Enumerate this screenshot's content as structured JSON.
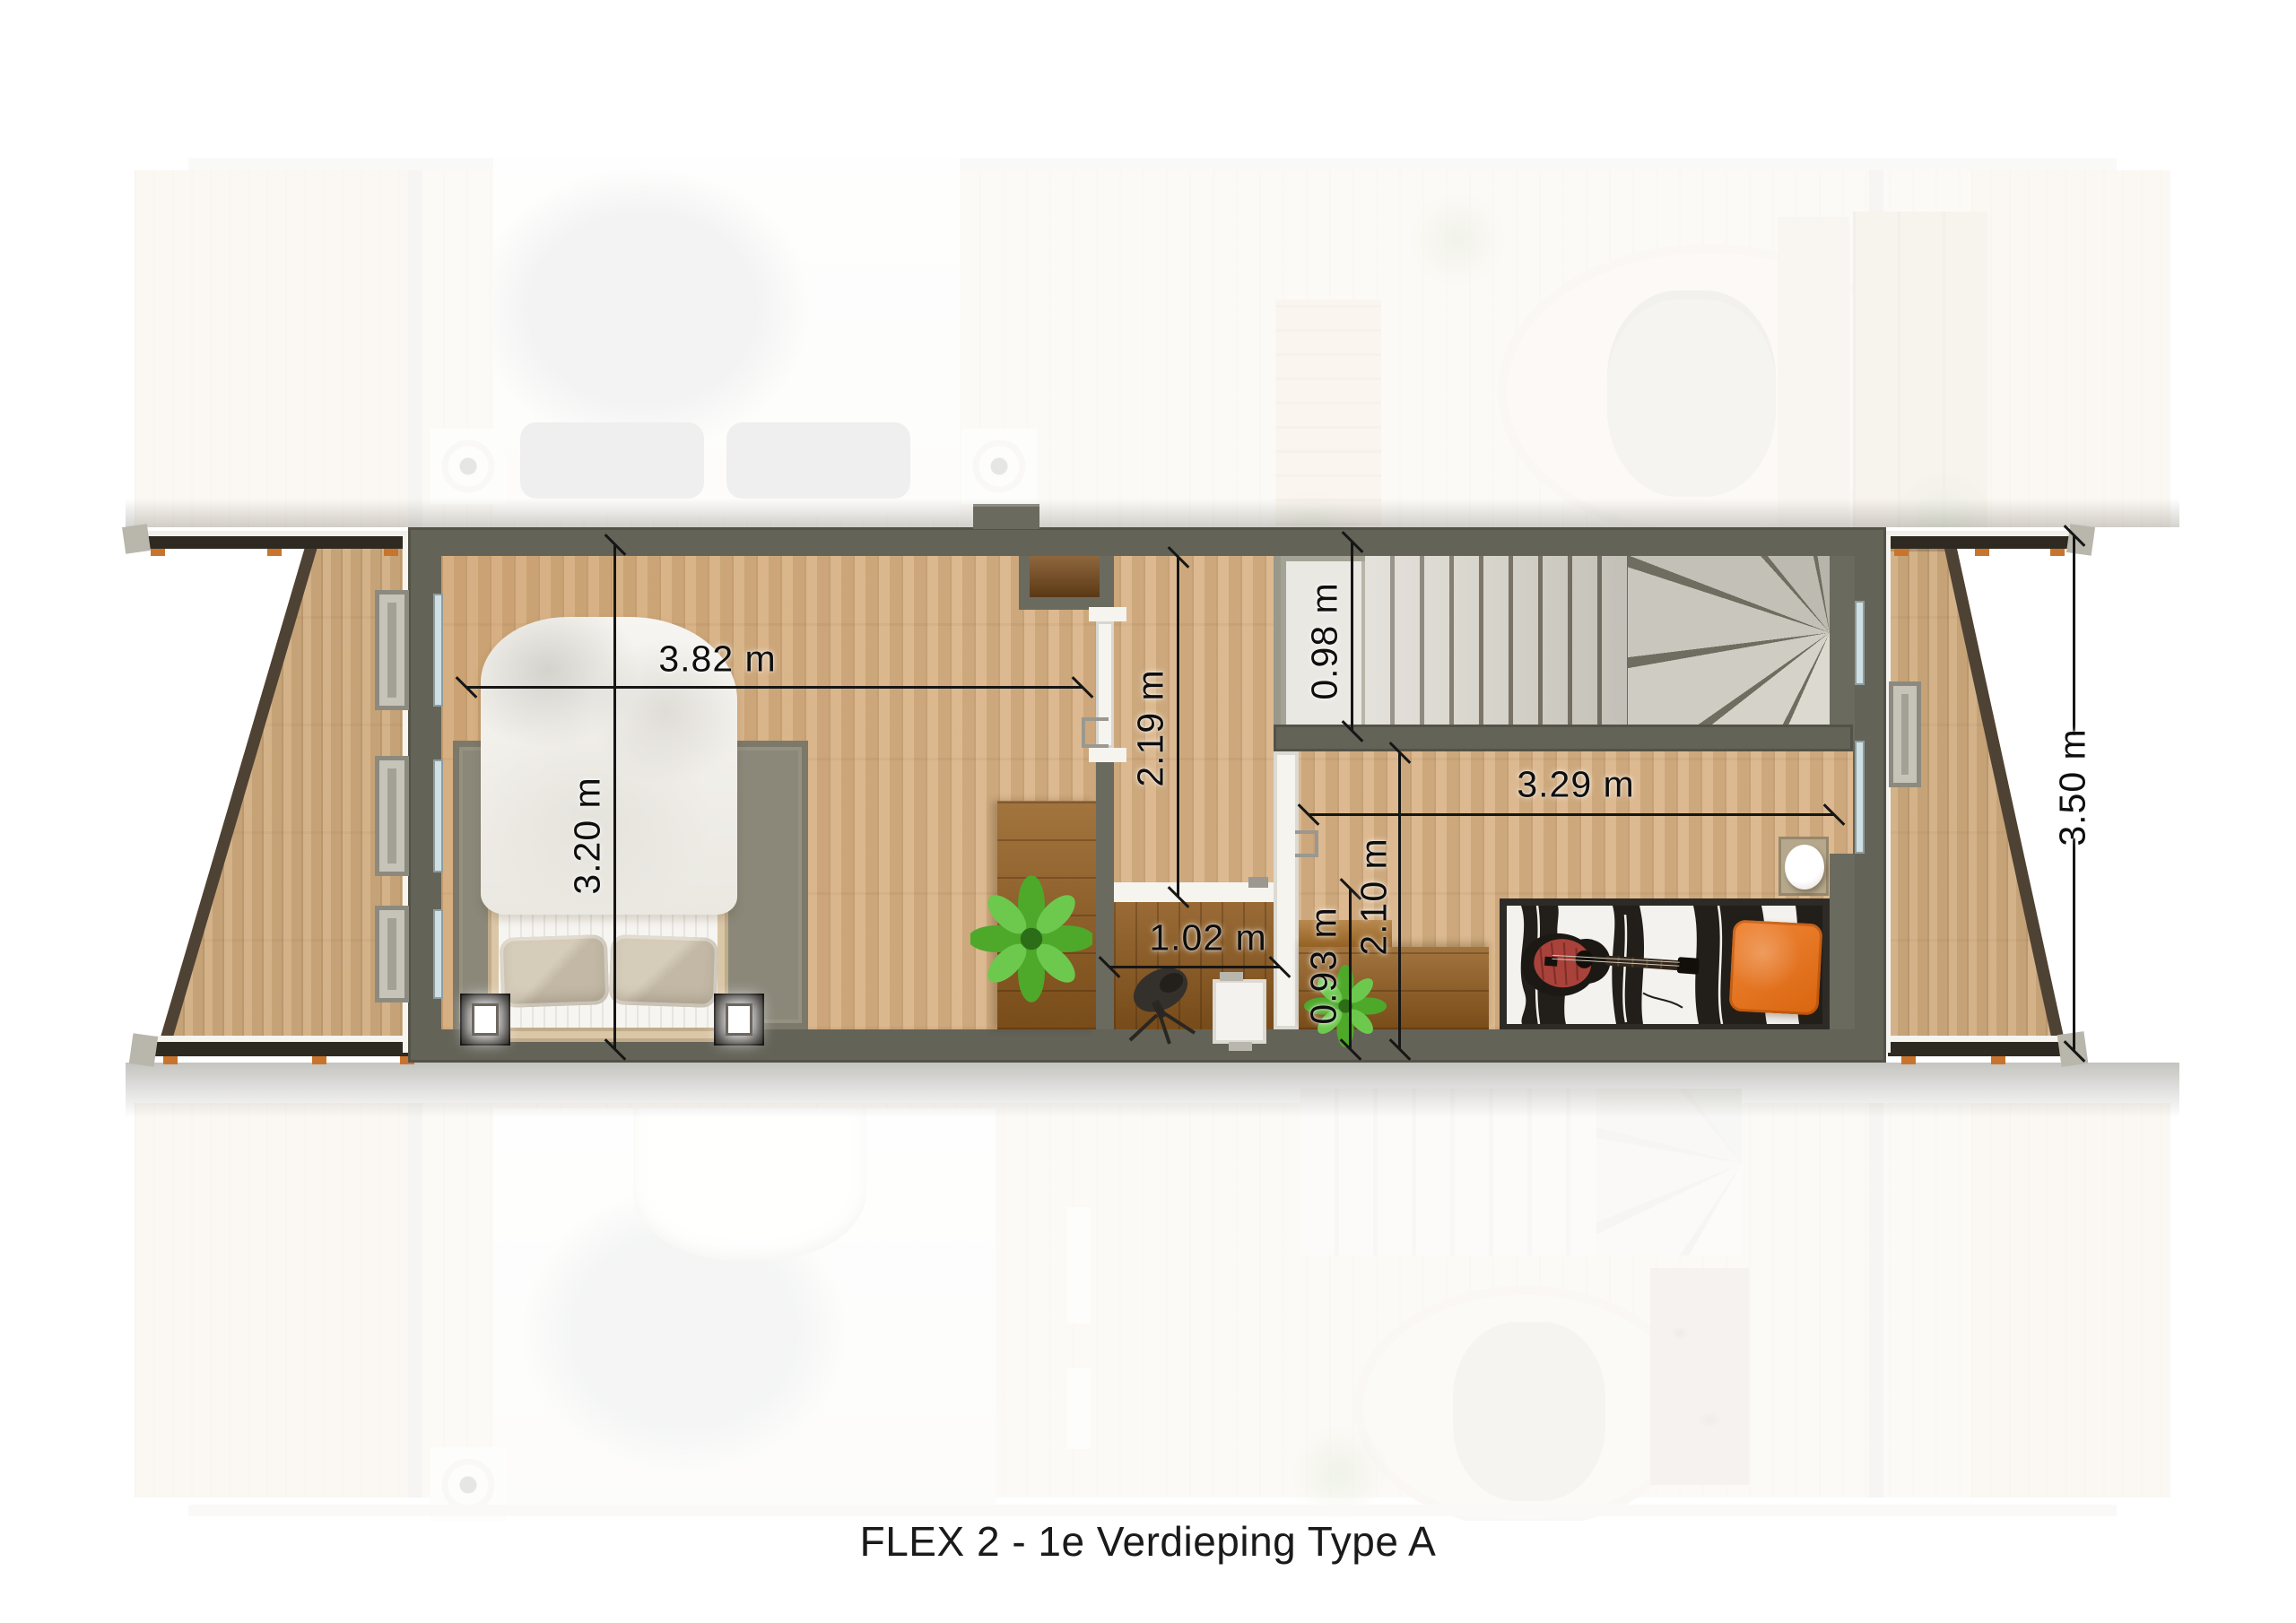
{
  "caption": "FLEX 2 - 1e Verdieping Type A",
  "dimensions": {
    "bedroom1_width": "3.82 m",
    "bedroom1_depth": "3.20 m",
    "landing_depth": "2.19 m",
    "stairs_width": "0.98 m",
    "bedroom2_width": "3.29 m",
    "bedroom2_depth": "2.10 m",
    "storage_width": "1.02 m",
    "passage_width": "0.93 m",
    "balcony_depth": "3.50 m"
  },
  "colors": {
    "wall": "#646358",
    "floor_wood": "#d8b183",
    "deck_wood": "#d0ab7d",
    "dark_wood": "#935d1e",
    "stair_tread": "#d8d5cc",
    "rug": "#8b887a",
    "bed_linen": "#f4f2ee",
    "pillow_beige": "#c9bead",
    "accent_orange": "#e87a28",
    "plant_green": "#4ea82a",
    "dimension_text": "#111111",
    "ghost_overlay": "rgba(255,255,255,0.78)"
  }
}
